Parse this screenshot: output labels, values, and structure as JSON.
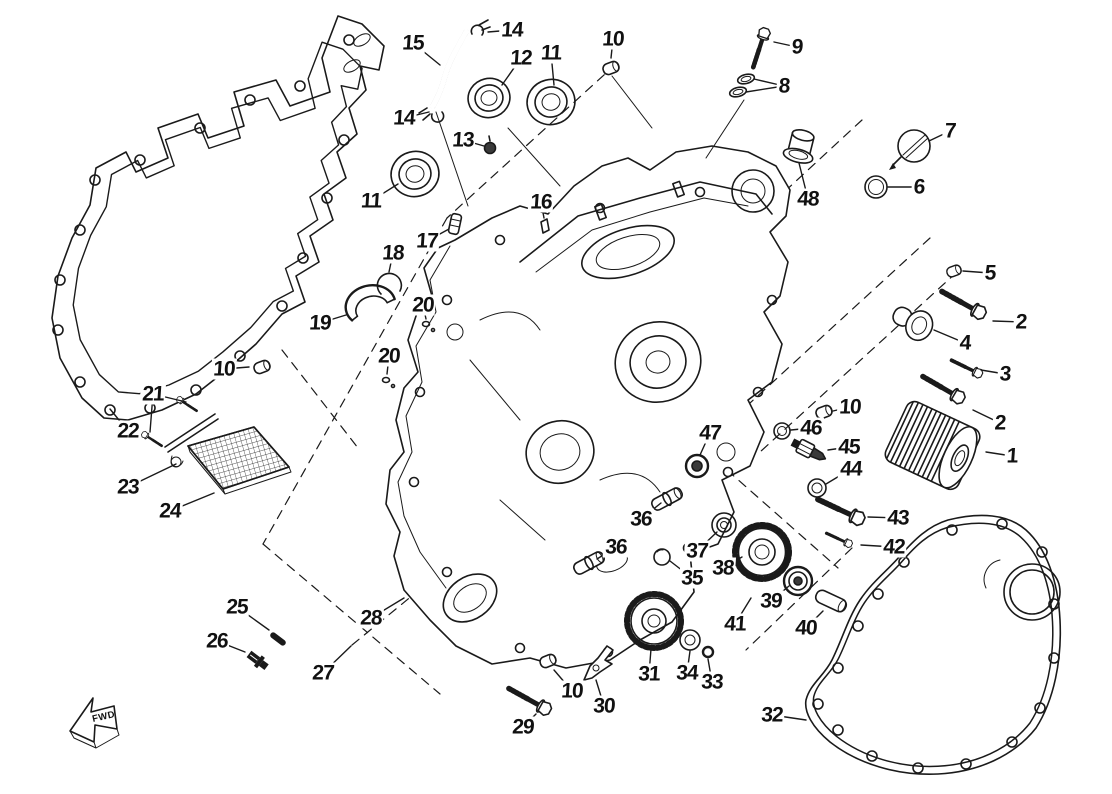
{
  "diagram": {
    "kind": "exploded-parts-diagram",
    "fwd_label": "FWD",
    "colors": {
      "ink": "#1a1a1a",
      "label": "#111111",
      "background": "#ffffff"
    },
    "labels": [
      {
        "text": "15",
        "x": 413,
        "y": 43,
        "lx": 440,
        "ly": 65
      },
      {
        "text": "14",
        "x": 512,
        "y": 30,
        "lx": 488,
        "ly": 32
      },
      {
        "text": "12",
        "x": 521,
        "y": 58,
        "lx": 502,
        "ly": 85
      },
      {
        "text": "11",
        "x": 551,
        "y": 53,
        "lx": 554,
        "ly": 85
      },
      {
        "text": "10",
        "x": 613,
        "y": 39,
        "lx": 611,
        "ly": 58
      },
      {
        "text": "9",
        "x": 797,
        "y": 47,
        "lx": 774,
        "ly": 42
      },
      {
        "text": "8",
        "x": 784,
        "y": 86,
        "lx": 754,
        "ly": 79,
        "lx2": 746,
        "ly2": 92
      },
      {
        "text": "48",
        "x": 808,
        "y": 199,
        "lx": 799,
        "ly": 163
      },
      {
        "text": "7",
        "x": 950,
        "y": 131,
        "lx": 929,
        "ly": 141
      },
      {
        "text": "6",
        "x": 919,
        "y": 187,
        "lx": 888,
        "ly": 187
      },
      {
        "text": "5",
        "x": 990,
        "y": 273,
        "lx": 963,
        "ly": 271
      },
      {
        "text": "2",
        "x": 1021,
        "y": 322,
        "lx": 993,
        "ly": 321
      },
      {
        "text": "4",
        "x": 965,
        "y": 343,
        "lx": 934,
        "ly": 330
      },
      {
        "text": "3",
        "x": 1005,
        "y": 374,
        "lx": 981,
        "ly": 370
      },
      {
        "text": "2",
        "x": 1000,
        "y": 423,
        "lx": 973,
        "ly": 410
      },
      {
        "text": "1",
        "x": 1012,
        "y": 456,
        "lx": 986,
        "ly": 452
      },
      {
        "text": "14",
        "x": 404,
        "y": 118,
        "lx": 429,
        "ly": 112
      },
      {
        "text": "13",
        "x": 463,
        "y": 140,
        "lx": 484,
        "ly": 146
      },
      {
        "text": "11",
        "x": 371,
        "y": 201,
        "lx": 398,
        "ly": 184
      },
      {
        "text": "17",
        "x": 427,
        "y": 241,
        "lx": 449,
        "ly": 229
      },
      {
        "text": "16",
        "x": 541,
        "y": 202,
        "lx": 544,
        "ly": 218
      },
      {
        "text": "18",
        "x": 393,
        "y": 253,
        "lx": 389,
        "ly": 272
      },
      {
        "text": "19",
        "x": 320,
        "y": 323,
        "lx": 346,
        "ly": 315
      },
      {
        "text": "20",
        "x": 423,
        "y": 305,
        "lx": 426,
        "ly": 319
      },
      {
        "text": "20",
        "x": 389,
        "y": 356,
        "lx": 387,
        "ly": 374
      },
      {
        "text": "10",
        "x": 224,
        "y": 369,
        "lx": 249,
        "ly": 367
      },
      {
        "text": "21",
        "x": 153,
        "y": 394,
        "lx": 186,
        "ly": 402,
        "lx2": 150,
        "ly2": 432
      },
      {
        "text": "22",
        "x": 128,
        "y": 431,
        "lx": 110,
        "ly": 409
      },
      {
        "text": "23",
        "x": 128,
        "y": 487,
        "lx": 176,
        "ly": 464
      },
      {
        "text": "24",
        "x": 170,
        "y": 511,
        "lx": 214,
        "ly": 493
      },
      {
        "text": "47",
        "x": 710,
        "y": 433,
        "lx": 700,
        "ly": 455
      },
      {
        "text": "10",
        "x": 850,
        "y": 407,
        "lx": 833,
        "ly": 411
      },
      {
        "text": "46",
        "x": 811,
        "y": 428,
        "lx": 791,
        "ly": 430
      },
      {
        "text": "45",
        "x": 849,
        "y": 447,
        "lx": 828,
        "ly": 450
      },
      {
        "text": "44",
        "x": 851,
        "y": 469,
        "lx": 826,
        "ly": 484
      },
      {
        "text": "43",
        "x": 898,
        "y": 518,
        "lx": 868,
        "ly": 517
      },
      {
        "text": "42",
        "x": 894,
        "y": 547,
        "lx": 861,
        "ly": 545
      },
      {
        "text": "36",
        "x": 641,
        "y": 519,
        "lx": 661,
        "ly": 503
      },
      {
        "text": "36",
        "x": 616,
        "y": 547,
        "lx": 597,
        "ly": 559
      },
      {
        "text": "37",
        "x": 697,
        "y": 551,
        "lx": 717,
        "ly": 532
      },
      {
        "text": "35",
        "x": 692,
        "y": 578,
        "lx": 670,
        "ly": 561
      },
      {
        "text": "38",
        "x": 723,
        "y": 568,
        "lx": 742,
        "ly": 557
      },
      {
        "text": "39",
        "x": 771,
        "y": 601,
        "lx": 789,
        "ly": 586
      },
      {
        "text": "41",
        "x": 735,
        "y": 624,
        "lx": 751,
        "ly": 598
      },
      {
        "text": "40",
        "x": 806,
        "y": 628,
        "lx": 823,
        "ly": 611
      },
      {
        "text": "31",
        "x": 649,
        "y": 674,
        "lx": 651,
        "ly": 649
      },
      {
        "text": "34",
        "x": 687,
        "y": 673,
        "lx": 690,
        "ly": 651
      },
      {
        "text": "33",
        "x": 712,
        "y": 682,
        "lx": 708,
        "ly": 659
      },
      {
        "text": "25",
        "x": 237,
        "y": 607,
        "lx": 269,
        "ly": 630
      },
      {
        "text": "26",
        "x": 217,
        "y": 641,
        "lx": 245,
        "ly": 652
      },
      {
        "text": "27",
        "x": 323,
        "y": 673,
        "lx": 351,
        "ly": 646
      },
      {
        "text": "28",
        "x": 371,
        "y": 618,
        "lx": 404,
        "ly": 598
      },
      {
        "text": "30",
        "x": 604,
        "y": 706,
        "lx": 596,
        "ly": 680
      },
      {
        "text": "10",
        "x": 572,
        "y": 691,
        "lx": 554,
        "ly": 670
      },
      {
        "text": "29",
        "x": 523,
        "y": 727,
        "lx": 536,
        "ly": 714
      },
      {
        "text": "32",
        "x": 772,
        "y": 715,
        "lx": 806,
        "ly": 720
      }
    ]
  }
}
